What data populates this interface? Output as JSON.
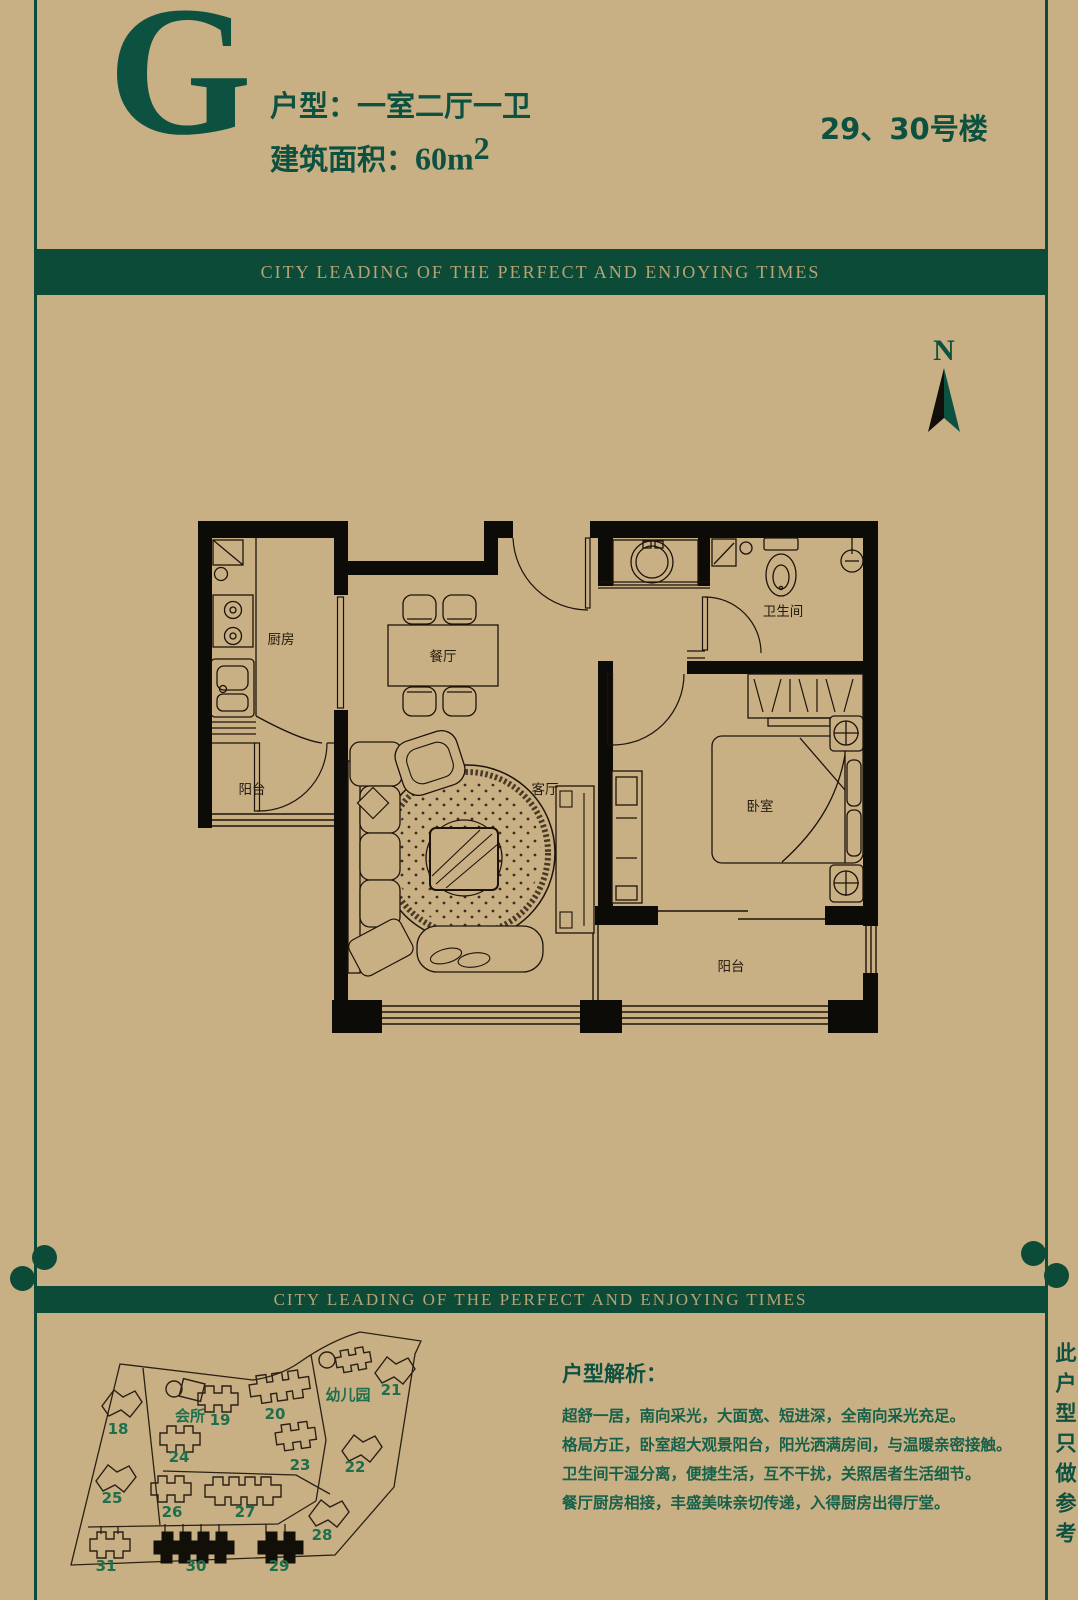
{
  "colors": {
    "background": "#c8b084",
    "accent_green": "#0c4b38",
    "title_green": "#0d5140",
    "map_label_green": "#1f6f4e",
    "banner_text": "#b9a273",
    "plan_ink": "#1c130a"
  },
  "header": {
    "unit_letter": "G",
    "unit_type": "户型：一室二厅一卫",
    "area_label": "建筑面积：",
    "area_value": "60",
    "area_unit": "m",
    "area_sup": "2",
    "building_no": "29、30号楼"
  },
  "banner": {
    "text": "CITY LEADING OF THE PERFECT AND ENJOYING TIMES"
  },
  "compass": {
    "label": "N"
  },
  "floor_plan": {
    "rooms": {
      "kitchen": "厨房",
      "dining": "餐厅",
      "living": "客厅",
      "bathroom": "卫生间",
      "bedroom": "卧室",
      "balcony_north": "阳台",
      "balcony_south": "阳台"
    }
  },
  "site_map": {
    "clubhouse": "会所",
    "kindergarten": "幼儿园",
    "highlighted": [
      "29",
      "30"
    ],
    "buildings": [
      {
        "label": "18"
      },
      {
        "label": "19"
      },
      {
        "label": "20"
      },
      {
        "label": "21"
      },
      {
        "label": "22"
      },
      {
        "label": "23"
      },
      {
        "label": "24"
      },
      {
        "label": "25"
      },
      {
        "label": "26"
      },
      {
        "label": "27"
      },
      {
        "label": "28"
      },
      {
        "label": "29"
      },
      {
        "label": "30"
      },
      {
        "label": "31"
      }
    ]
  },
  "analysis": {
    "title": "户型解析：",
    "lines": [
      "超舒一居，南向采光，大面宽、短进深，全南向采光充足。",
      "格局方正，卧室超大观景阳台，阳光洒满房间，与温暖亲密接触。",
      "卫生间干湿分离，便捷生活，互不干扰，关照居者生活细节。",
      "餐厅厨房相接，丰盛美味亲切传递，入得厨房出得厅堂。"
    ]
  },
  "side_note": "此户型只做参考"
}
